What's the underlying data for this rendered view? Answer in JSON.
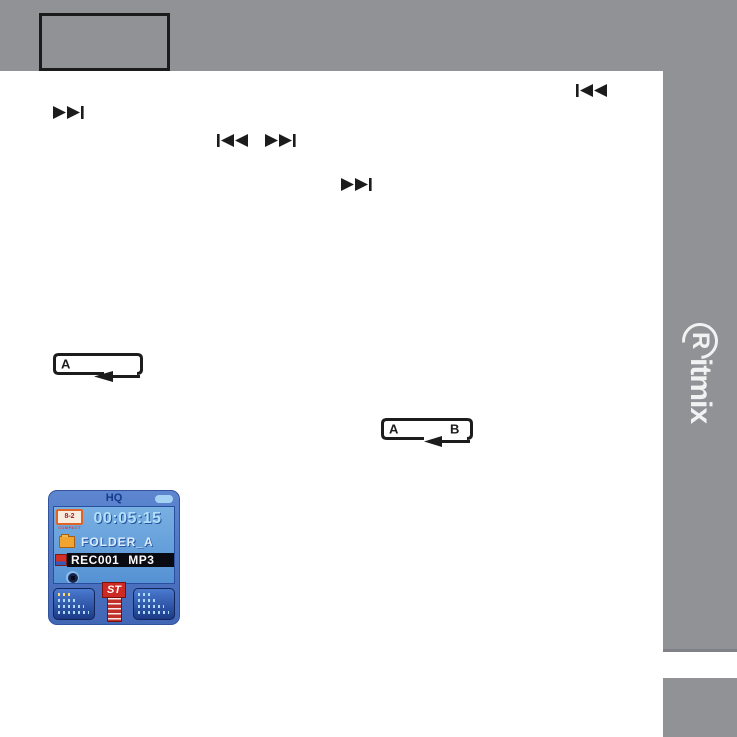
{
  "colors": {
    "gray": "#909296",
    "page_bg": "#ffffff",
    "icon_black": "#1c1c1c",
    "accent_red": "#cc2a22"
  },
  "sidebar": {
    "brand_initial": "R",
    "brand_rest": "itmix"
  },
  "icons": {
    "repeat_a": {
      "a": "A"
    },
    "repeat_ab": {
      "a": "A",
      "b": "B"
    }
  },
  "player": {
    "quality": "HQ",
    "time": "00:05:15",
    "folder": "FOLDER_A",
    "file": "REC001 MP3",
    "brand_badge": "8-2",
    "brand_caption": "COMPACT",
    "stereo_badge": "ST"
  }
}
